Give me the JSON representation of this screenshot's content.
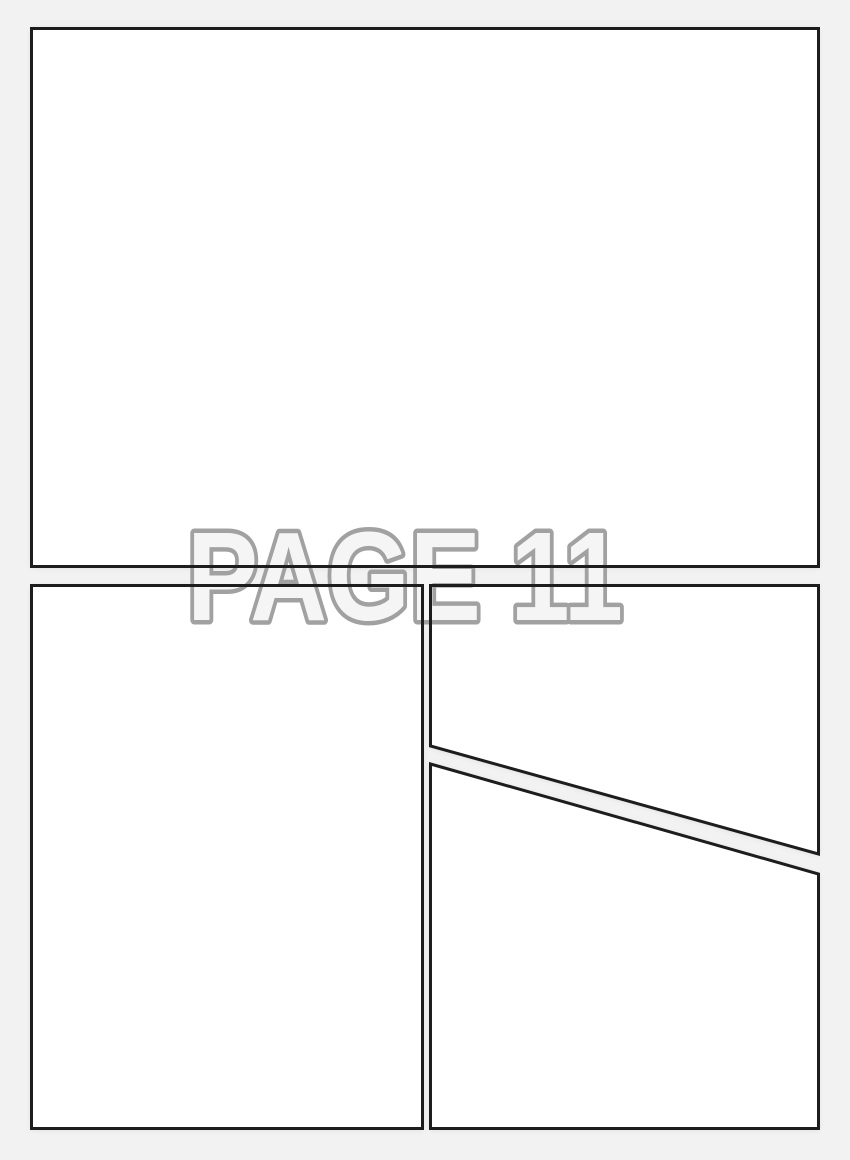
{
  "page": {
    "label": "PAGE 11",
    "colors": {
      "background": "#f2f2f2",
      "panel_fill": "#ffffff",
      "panel_border": "#1d1d1d",
      "label_fill": "#f5f5f5",
      "label_outline": "#a1a1a1"
    },
    "panels": [
      {
        "id": "top",
        "shape": "rectangle"
      },
      {
        "id": "bottom-left",
        "shape": "rectangle"
      },
      {
        "id": "bottom-right-upper",
        "shape": "diagonal-cut"
      },
      {
        "id": "bottom-right-lower",
        "shape": "diagonal-cut"
      }
    ]
  }
}
